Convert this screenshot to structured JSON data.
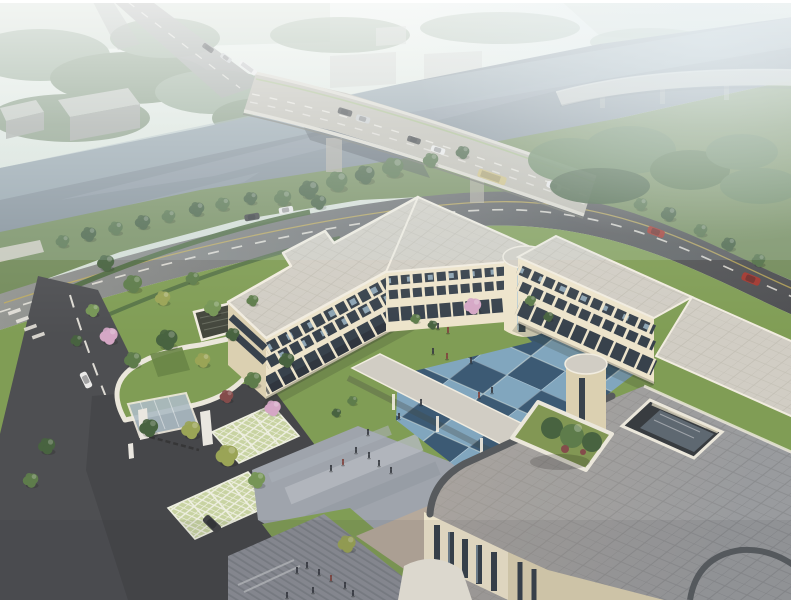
{
  "meta": {
    "kind": "architectural-aerial-rendering",
    "width": 800,
    "height": 600,
    "description": "Bird's-eye architectural rendering of a cream three-storey courtyard building complex with a blue checkerboard courtyard, landscaped gardens, gated entry with grass-paver parking, a roof terrace with planter and skylight, set beside a tree-lined river crossed by a highway bridge in morning haze."
  },
  "scene": {
    "buildings": [
      "northwest-wing",
      "north-wing",
      "east-wing",
      "front-wing",
      "green-roof-annex",
      "distant-warehouses"
    ],
    "roads": [
      "riverside-road",
      "left-street",
      "bridge-highway",
      "distant-viaduct",
      "entry-driveway"
    ],
    "courtyard_paving": "blue checkerboard tiles",
    "vehicle_count": 15,
    "pedestrian_count": 24,
    "parked_vehicles": 2,
    "water": "river flowing diagonally upper-left to upper-right"
  },
  "palette": {
    "haze_top": "#e9efe9",
    "haze_mid": "#d6e1d9",
    "haze_low": "#c9d4cc",
    "water": "#7b8894",
    "water_far": "#a2b4bc",
    "water_light": "#95a2ac",
    "field": "#b7c6b4",
    "far_tree": "#8aa089",
    "far_tree_dark": "#748b70",
    "warehouse": "#c2c6c1",
    "warehouse_side": "#9fa49f",
    "box_light": "#ccd0cb",
    "forest_ne": "#5d7d54",
    "bank_tree": "#4c6c43",
    "bank_tree_dark": "#3d593a",
    "tree_dark": "#3f5c38",
    "tree_mid": "#567744",
    "tree_light": "#6f9150",
    "tree_yellow": "#95a150",
    "tree_pink": "#d3a4c5",
    "tree_red": "#7e4444",
    "lawn": "#7a994f",
    "lawn_dark": "#63813f",
    "hedge": "#47653c",
    "verge": "#6d8756",
    "road_dark": "#45474b",
    "road_mid": "#55585c",
    "road_far": "#9a9e9b",
    "asphalt_drive": "#3d3f43",
    "lane_white": "#eceae2",
    "lane_yellow": "#c4ae52",
    "lane_green": "#9cb87c",
    "bridge_deck": "#bcb9af",
    "bridge_edge": "#dcd9cf",
    "viaduct": "#c6c9c4",
    "cream": "#ece4cb",
    "cream_shade": "#dacfaf",
    "cream_dark": "#c8ba97",
    "trim": "#f1ede1",
    "roof_light": "#cfccc3",
    "roof_line": "#bdbab0",
    "terrace": "#94979b",
    "terrace_warm": "#b0a99c",
    "terrace_line": "#84878b",
    "terrace_edge": "#4e5357",
    "window_dark": "#2e3945",
    "glass_blue": "#a6c4d6",
    "court_light": "#7ba3bd",
    "court_dark": "#32536f",
    "plaza": "#9aa1aa",
    "plaza_light": "#b2b8bf",
    "plaza_mid": "#8f96a0",
    "walkway_gray": "#868b93",
    "walkway_stripe": "#767b83",
    "plaza_warm": "#b3a698",
    "paver": "#c6d2a0",
    "paver_line": "#eef0e2",
    "canopy_white": "#eae7dc",
    "canopy_glass": "#a9bac4",
    "gate_dark": "#2c2d2f",
    "pillar": "#e9e7e1",
    "planter_green": "#7c934d",
    "skylight_dark": "#2e3338",
    "skylight_glass": "#59646f",
    "car_red": "#9e2f28",
    "car_dark": "#393c3f",
    "car_white": "#eaeaea",
    "car_silver": "#c6c9cb",
    "bus_yellow": "#cdbd7e",
    "people": "#2e323a",
    "people_alt": "#7a3b36",
    "frame": "#ffffff",
    "fog": "#ffffff"
  }
}
